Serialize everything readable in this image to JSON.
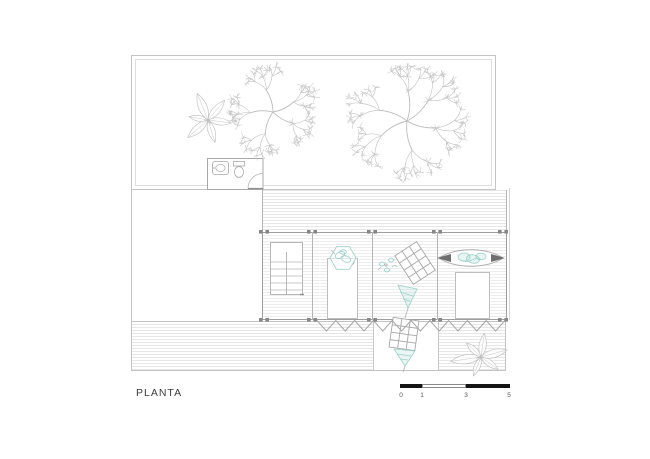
{
  "title": {
    "label": "PLANTA"
  },
  "scale_bar": {
    "tick_labels": [
      "0",
      "1",
      "3",
      "5"
    ]
  },
  "colors": {
    "line_light": "#d8d8d8",
    "line_gray": "#c4c4c4",
    "wall_gray": "#9e9e9e",
    "fixture_gray": "#a8a8a8",
    "tree_line": "#bcbcbc",
    "foliage": "#c7c7c7",
    "accent_teal": "#9ccfc8",
    "accent_teal_fill": "rgba(163,214,207,0.22)",
    "column_gray": "#878787",
    "zigzag_gray": "#a6a6a6",
    "scalebar_black": "#141414",
    "text_dark": "#3c3c3c"
  }
}
